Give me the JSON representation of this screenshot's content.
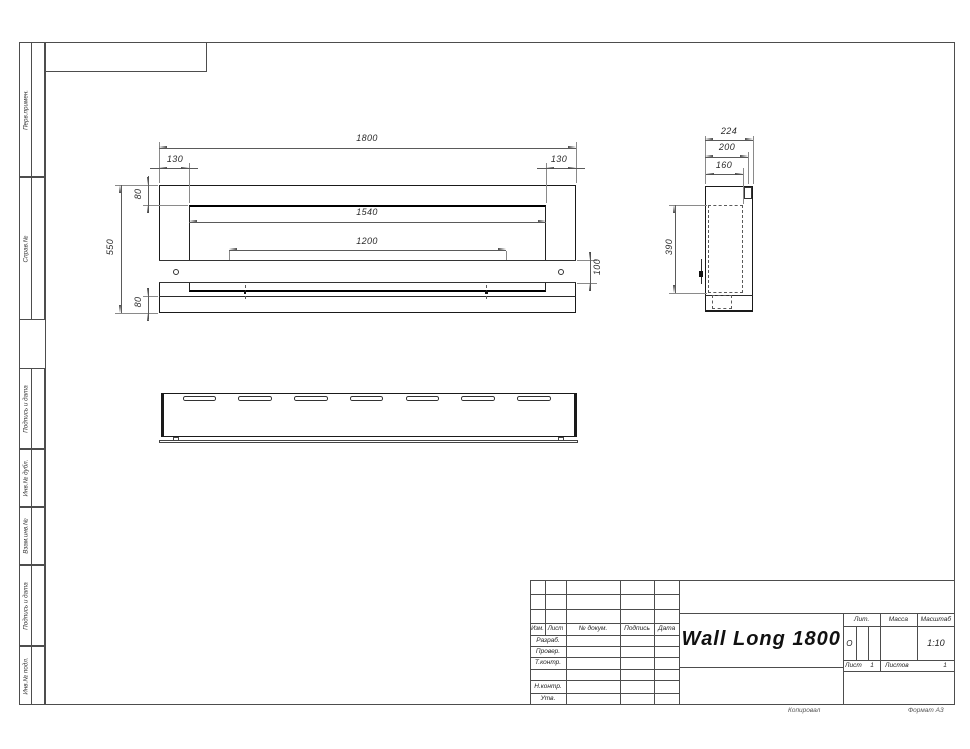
{
  "sheet": {
    "margin_labels": [
      "Перв.примен.",
      "Справ.№",
      "Подпись и дата",
      "Инв.№ дубл.",
      "Взам.инв.№",
      "Подпись и дата",
      "Инв.№ подл."
    ],
    "footer": {
      "copied": "Копировал",
      "format": "Формат А3"
    }
  },
  "views": {
    "front": {
      "dims": {
        "total_width": "1800",
        "left_offset": "130",
        "right_offset": "130",
        "top_flange": "80",
        "total_height": "550",
        "opening_width": "1540",
        "mount_span": "1200",
        "band_height": "100",
        "bottom_flange": "80"
      }
    },
    "side": {
      "dims": {
        "depth_total": "224",
        "depth_body": "200",
        "depth_inner": "160",
        "inner_height": "390"
      }
    },
    "bottom": {
      "slot_count": 7
    }
  },
  "title_block": {
    "header_cols": [
      "Изм.",
      "Лист",
      "№ докум.",
      "Подпись",
      "Дата"
    ],
    "row_labels": [
      "Разраб.",
      "Провер.",
      "Т.контр.",
      "Н.контр.",
      "Утв."
    ],
    "title": "Wall Long 1800",
    "lit_label": "Лит.",
    "mass_label": "Масса",
    "scale_label": "Масштаб",
    "lit_value": "О",
    "scale_value": "1:10",
    "sheet_label": "Лист",
    "sheet_value": "1",
    "sheets_label": "Листов",
    "sheets_value": "1"
  }
}
